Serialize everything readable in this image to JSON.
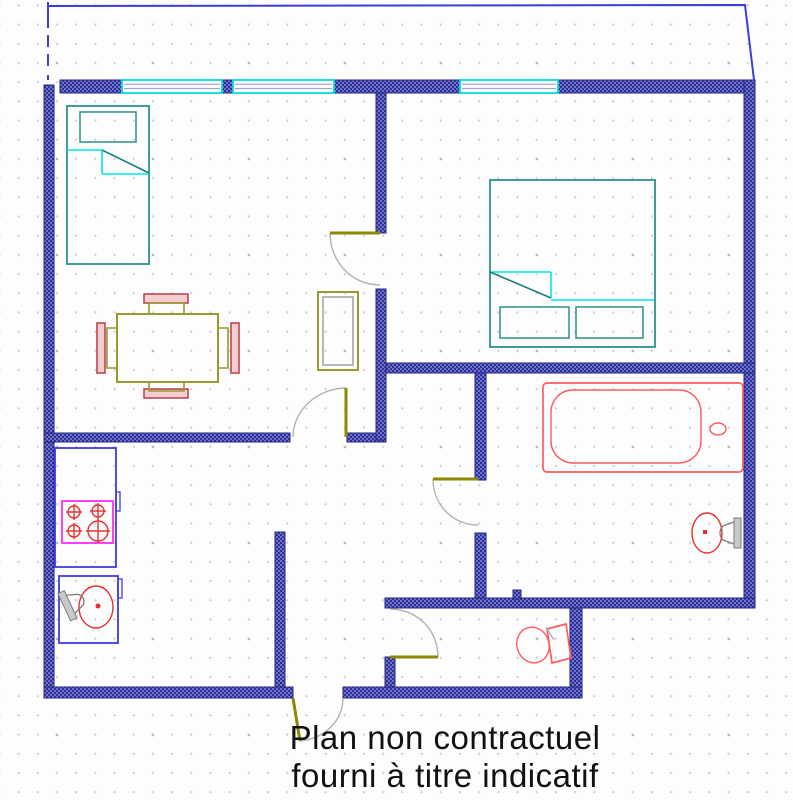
{
  "caption": {
    "line1": "Plan non contractuel",
    "line2": "fourni à titre indicatif"
  },
  "colors": {
    "wall_blue": "#2e3192",
    "wall_weave_light": "#6f73cf",
    "balcony_blue": "#3d3dd8",
    "window_cyan": "#00dede",
    "window_glass_line": "#8a97c8",
    "bed_teal": "#2e8f8f",
    "sheet_cyan": "#00e8e8",
    "sheet_fold_teal": "#1d7d7d",
    "door_leaf_olive": "#8a8a00",
    "door_arc_gray": "#b2b2b2",
    "table_olive": "#99992e",
    "chair_border_red": "#b04048",
    "chair_fill_pink": "#f6cdd0",
    "counter_blue": "#3d3de0",
    "stove_magenta": "#ff2bff",
    "burner_sink_red": "#e73030",
    "tub_toilet_red": "#ff5b5b",
    "metal_gray": "#7d7d7d",
    "caption_black": "#111111"
  },
  "plan": {
    "canvas": {
      "width": 793,
      "height": 800
    },
    "balcony_lines": [
      {
        "name": "balcony-outline-left",
        "points": "48,2 48,80",
        "dashed": true
      },
      {
        "name": "balcony-outline-top",
        "points": "48,6 745,5 754,80",
        "dashed": false
      }
    ],
    "walls": [
      {
        "name": "wall-exterior-left",
        "x": 44,
        "y": 85,
        "w": 10,
        "h": 613
      },
      {
        "name": "wall-exterior-top-1",
        "x": 60,
        "y": 80,
        "w": 62,
        "h": 13
      },
      {
        "name": "wall-window-pier",
        "x": 222,
        "y": 80,
        "w": 11,
        "h": 13
      },
      {
        "name": "wall-exterior-top-2",
        "x": 334,
        "y": 80,
        "w": 126,
        "h": 13
      },
      {
        "name": "wall-exterior-top-3",
        "x": 558,
        "y": 80,
        "w": 197,
        "h": 13
      },
      {
        "name": "wall-exterior-right",
        "x": 744,
        "y": 80,
        "w": 11,
        "h": 527
      },
      {
        "name": "wall-exterior-south-upper",
        "x": 385,
        "y": 598,
        "w": 370,
        "h": 10
      },
      {
        "name": "wall-wc-right",
        "x": 570,
        "y": 608,
        "w": 12,
        "h": 90
      },
      {
        "name": "wall-exterior-bottom-left",
        "x": 44,
        "y": 687,
        "w": 249,
        "h": 11
      },
      {
        "name": "wall-exterior-bottom-right",
        "x": 343,
        "y": 687,
        "w": 239,
        "h": 11
      },
      {
        "name": "wall-wc-left-stub",
        "x": 385,
        "y": 657,
        "w": 10,
        "h": 30
      },
      {
        "name": "wall-kitchen",
        "x": 275,
        "y": 532,
        "w": 10,
        "h": 155
      },
      {
        "name": "wall-living-hall-left",
        "x": 44,
        "y": 433,
        "w": 246,
        "h": 9
      },
      {
        "name": "wall-living-hall-right",
        "x": 347,
        "y": 433,
        "w": 39,
        "h": 9
      },
      {
        "name": "wall-bedroom-upper",
        "x": 376,
        "y": 93,
        "w": 10,
        "h": 140
      },
      {
        "name": "wall-bedroom-lower",
        "x": 376,
        "y": 289,
        "w": 10,
        "h": 151
      },
      {
        "name": "wall-bedroom-bath",
        "x": 386,
        "y": 363,
        "w": 369,
        "h": 10
      },
      {
        "name": "wall-bath-left-upper",
        "x": 475,
        "y": 373,
        "w": 11,
        "h": 107
      },
      {
        "name": "wall-bath-left-lower",
        "x": 475,
        "y": 533,
        "w": 11,
        "h": 65
      },
      {
        "name": "wall-stub-small",
        "x": 513,
        "y": 590,
        "w": 8,
        "h": 9
      }
    ],
    "windows": [
      {
        "name": "window-1",
        "x": 122,
        "y": 80,
        "w": 100,
        "h": 13
      },
      {
        "name": "window-2",
        "x": 233,
        "y": 80,
        "w": 101,
        "h": 13
      },
      {
        "name": "window-3",
        "x": 460,
        "y": 80,
        "w": 98,
        "h": 13
      }
    ],
    "doors": [
      {
        "name": "bedroom-door",
        "leaf": [
          330,
          233,
          380,
          233
        ],
        "arc": "M330,233 C330,262 352,285 380,285"
      },
      {
        "name": "living-room-door",
        "leaf": [
          346,
          388,
          346,
          437
        ],
        "arc": "M346,388 C319,388 293,409 293,437"
      },
      {
        "name": "bathroom-door",
        "leaf": [
          433,
          479,
          478,
          479
        ],
        "arc": "M433,479 C433,505 453,525 478,525"
      },
      {
        "name": "wc-door",
        "leaf": [
          390,
          657,
          438,
          657
        ],
        "arc": "M390,609 C417,609 438,630 438,657"
      },
      {
        "name": "entry-door",
        "leaf": [
          293,
          698,
          300,
          741
        ],
        "arc": "M343,698 C343,721 324,739 300,741"
      }
    ],
    "furniture": [
      {
        "name": "single-bed",
        "type": "rect",
        "cls": "teal",
        "x": 67,
        "y": 106,
        "w": 82,
        "h": 158
      },
      {
        "name": "single-bed-pillow",
        "type": "rect",
        "cls": "teal-thin",
        "x": 80,
        "y": 112,
        "w": 56,
        "h": 30
      },
      {
        "name": "single-bed-sheet-line",
        "type": "line",
        "cls": "cyan",
        "x1": 67,
        "y1": 150,
        "x2": 102,
        "y2": 150
      },
      {
        "name": "single-bed-sheet-line",
        "type": "line",
        "cls": "cyan",
        "x1": 102,
        "y1": 150,
        "x2": 102,
        "y2": 174
      },
      {
        "name": "single-bed-sheet-line",
        "type": "line",
        "cls": "cyan",
        "x1": 102,
        "y1": 174,
        "x2": 149,
        "y2": 174
      },
      {
        "name": "single-bed-sheet-fold",
        "type": "line",
        "cls": "tealdiag",
        "x1": 102,
        "y1": 150,
        "x2": 149,
        "y2": 173
      },
      {
        "name": "double-bed",
        "type": "rect",
        "cls": "teal",
        "x": 490,
        "y": 180,
        "w": 165,
        "h": 167
      },
      {
        "name": "double-bed-pillow",
        "type": "rect",
        "cls": "teal-thin",
        "x": 500,
        "y": 307,
        "w": 69,
        "h": 31
      },
      {
        "name": "double-bed-pillow",
        "type": "rect",
        "cls": "teal-thin",
        "x": 576,
        "y": 307,
        "w": 67,
        "h": 31
      },
      {
        "name": "double-bed-sheet-line",
        "type": "line",
        "cls": "cyan",
        "x1": 490,
        "y1": 272,
        "x2": 551,
        "y2": 272
      },
      {
        "name": "double-bed-sheet-line",
        "type": "line",
        "cls": "cyan",
        "x1": 551,
        "y1": 272,
        "x2": 551,
        "y2": 298
      },
      {
        "name": "double-bed-sheet-line",
        "type": "line",
        "cls": "cyan",
        "x1": 551,
        "y1": 300,
        "x2": 654,
        "y2": 300
      },
      {
        "name": "double-bed-sheet-fold",
        "type": "line",
        "cls": "tealdiag",
        "x1": 490,
        "y1": 272,
        "x2": 551,
        "y2": 298
      },
      {
        "name": "wardrobe",
        "type": "rect",
        "cls": "olive",
        "x": 318,
        "y": 292,
        "w": 40,
        "h": 78
      },
      {
        "name": "wardrobe-inner",
        "type": "rect",
        "cls": "grayline",
        "x": 323,
        "y": 297,
        "w": 30,
        "h": 68
      },
      {
        "name": "dining-table",
        "type": "rect",
        "cls": "olive",
        "x": 117,
        "y": 314,
        "w": 101,
        "h": 68
      },
      {
        "name": "chair-back",
        "type": "rect",
        "cls": "chair",
        "x": 144,
        "y": 294,
        "w": 44,
        "h": 9
      },
      {
        "name": "chair-seat",
        "type": "path",
        "cls": "olive-thin",
        "d": "M149,314 L149,303 L184,303 L184,314"
      },
      {
        "name": "chair-back",
        "type": "rect",
        "cls": "chair",
        "x": 144,
        "y": 389,
        "w": 44,
        "h": 9
      },
      {
        "name": "chair-seat",
        "type": "path",
        "cls": "olive-thin",
        "d": "M149,382 L149,391 L184,391 L184,382"
      },
      {
        "name": "chair-back",
        "type": "rect",
        "cls": "chair",
        "x": 97,
        "y": 323,
        "w": 8,
        "h": 50
      },
      {
        "name": "chair-seat",
        "type": "path",
        "cls": "olive-thin",
        "d": "M117,328 L107,328 L107,368 L117,368"
      },
      {
        "name": "chair-back",
        "type": "rect",
        "cls": "chair",
        "x": 231,
        "y": 323,
        "w": 8,
        "h": 50
      },
      {
        "name": "chair-seat",
        "type": "path",
        "cls": "olive-thin",
        "d": "M218,328 L228,328 L228,368 L218,368"
      },
      {
        "name": "kitchen-counter",
        "type": "rect",
        "cls": "counter",
        "x": 55,
        "y": 448,
        "w": 61,
        "h": 119
      },
      {
        "name": "kitchen-counter-handle",
        "type": "rect",
        "cls": "counter-thin",
        "x": 116,
        "y": 492,
        "w": 4,
        "h": 19
      },
      {
        "name": "stove",
        "type": "rect",
        "cls": "stove",
        "x": 62,
        "y": 501,
        "w": 51,
        "h": 42
      },
      {
        "name": "stove-burner",
        "type": "circle",
        "cls": "red-thin",
        "cx": 74,
        "cy": 512,
        "r": 6
      },
      {
        "name": "stove-burner-cross",
        "type": "line",
        "cls": "red-thin",
        "x1": 74,
        "y1": 504,
        "x2": 74,
        "y2": 520
      },
      {
        "name": "stove-burner-cross",
        "type": "line",
        "cls": "red-thin",
        "x1": 66,
        "y1": 512,
        "x2": 82,
        "y2": 512
      },
      {
        "name": "stove-burner",
        "type": "circle",
        "cls": "red-thin",
        "cx": 98,
        "cy": 511,
        "r": 6
      },
      {
        "name": "stove-burner-cross",
        "type": "line",
        "cls": "red-thin",
        "x1": 98,
        "y1": 503,
        "x2": 98,
        "y2": 519
      },
      {
        "name": "stove-burner-cross",
        "type": "line",
        "cls": "red-thin",
        "x1": 90,
        "y1": 511,
        "x2": 106,
        "y2": 511
      },
      {
        "name": "stove-burner",
        "type": "circle",
        "cls": "red-thin",
        "cx": 74,
        "cy": 531,
        "r": 6
      },
      {
        "name": "stove-burner-cross",
        "type": "line",
        "cls": "red-thin",
        "x1": 74,
        "y1": 523,
        "x2": 74,
        "y2": 539
      },
      {
        "name": "stove-burner-cross",
        "type": "line",
        "cls": "red-thin",
        "x1": 66,
        "y1": 531,
        "x2": 82,
        "y2": 531
      },
      {
        "name": "stove-burner",
        "type": "circle",
        "cls": "red-thin",
        "cx": 98,
        "cy": 531,
        "r": 10
      },
      {
        "name": "stove-burner-cross",
        "type": "line",
        "cls": "red-thin",
        "x1": 98,
        "y1": 519,
        "x2": 98,
        "y2": 543
      },
      {
        "name": "stove-burner-cross",
        "type": "line",
        "cls": "red-thin",
        "x1": 86,
        "y1": 531,
        "x2": 110,
        "y2": 531
      },
      {
        "name": "sink-cabinet",
        "type": "rect",
        "cls": "counter",
        "x": 59,
        "y": 576,
        "w": 59,
        "h": 67
      },
      {
        "name": "sink-cabinet-handle",
        "type": "rect",
        "cls": "counter-thin",
        "x": 118,
        "y": 579,
        "w": 4,
        "h": 19
      },
      {
        "name": "kitchen-sink",
        "type": "ellipse",
        "cls": "red-thin",
        "cx": 96,
        "cy": 607,
        "rx": 17,
        "ry": 21
      },
      {
        "name": "kitchen-sink-drain",
        "type": "circle",
        "cls": "redfill",
        "cx": 98,
        "cy": 606,
        "r": 2.5
      },
      {
        "name": "kitchen-faucet",
        "type": "rect",
        "cls": "metalfill",
        "x": 64,
        "y": 591,
        "w": 7,
        "h": 30,
        "transform": "rotate(-25 67 606)"
      },
      {
        "name": "kitchen-faucet",
        "type": "path",
        "cls": "metal-line",
        "d": "M71,596 L82,600 M71,616 L82,612 M82,600 C86,604 86,608 82,612",
        "transform": "rotate(-25 67 606)"
      },
      {
        "name": "bathtub",
        "type": "rect",
        "cls": "tub",
        "x": 543,
        "y": 383,
        "w": 200,
        "h": 89,
        "rx": 4
      },
      {
        "name": "bathtub-inner",
        "type": "rect",
        "cls": "tub-thin",
        "x": 551,
        "y": 390,
        "w": 150,
        "h": 73,
        "rx": 22
      },
      {
        "name": "bathtub-drain",
        "type": "ellipse",
        "cls": "tub-thin",
        "cx": 718,
        "cy": 429,
        "rx": 8,
        "ry": 6
      },
      {
        "name": "washbasin",
        "type": "ellipse",
        "cls": "red-thin",
        "cx": 707,
        "cy": 533,
        "rx": 15,
        "ry": 20
      },
      {
        "name": "washbasin-dot",
        "type": "rect",
        "cls": "redfill",
        "x": 703,
        "y": 530,
        "w": 4,
        "h": 4
      },
      {
        "name": "washbasin-faucet",
        "type": "rect",
        "cls": "metalfill",
        "x": 734,
        "y": 518,
        "w": 7,
        "h": 30
      },
      {
        "name": "washbasin-faucet",
        "type": "path",
        "cls": "metal-line",
        "d": "M734,522 L723,526 M734,544 L723,540 M723,526 C719,530 719,536 723,540"
      },
      {
        "name": "toilet-bowl",
        "type": "ellipse",
        "cls": "tub-thin",
        "cx": 533,
        "cy": 645,
        "rx": 16,
        "ry": 18,
        "transform": "rotate(-20 533 645)"
      },
      {
        "name": "toilet-tank",
        "type": "polygon",
        "cls": "tub",
        "points": "547,629 566,624 571,658 552,663"
      },
      {
        "name": "toilet-hinge",
        "type": "line",
        "cls": "arc",
        "x1": 546,
        "y1": 627,
        "x2": 554,
        "y2": 640
      }
    ]
  }
}
